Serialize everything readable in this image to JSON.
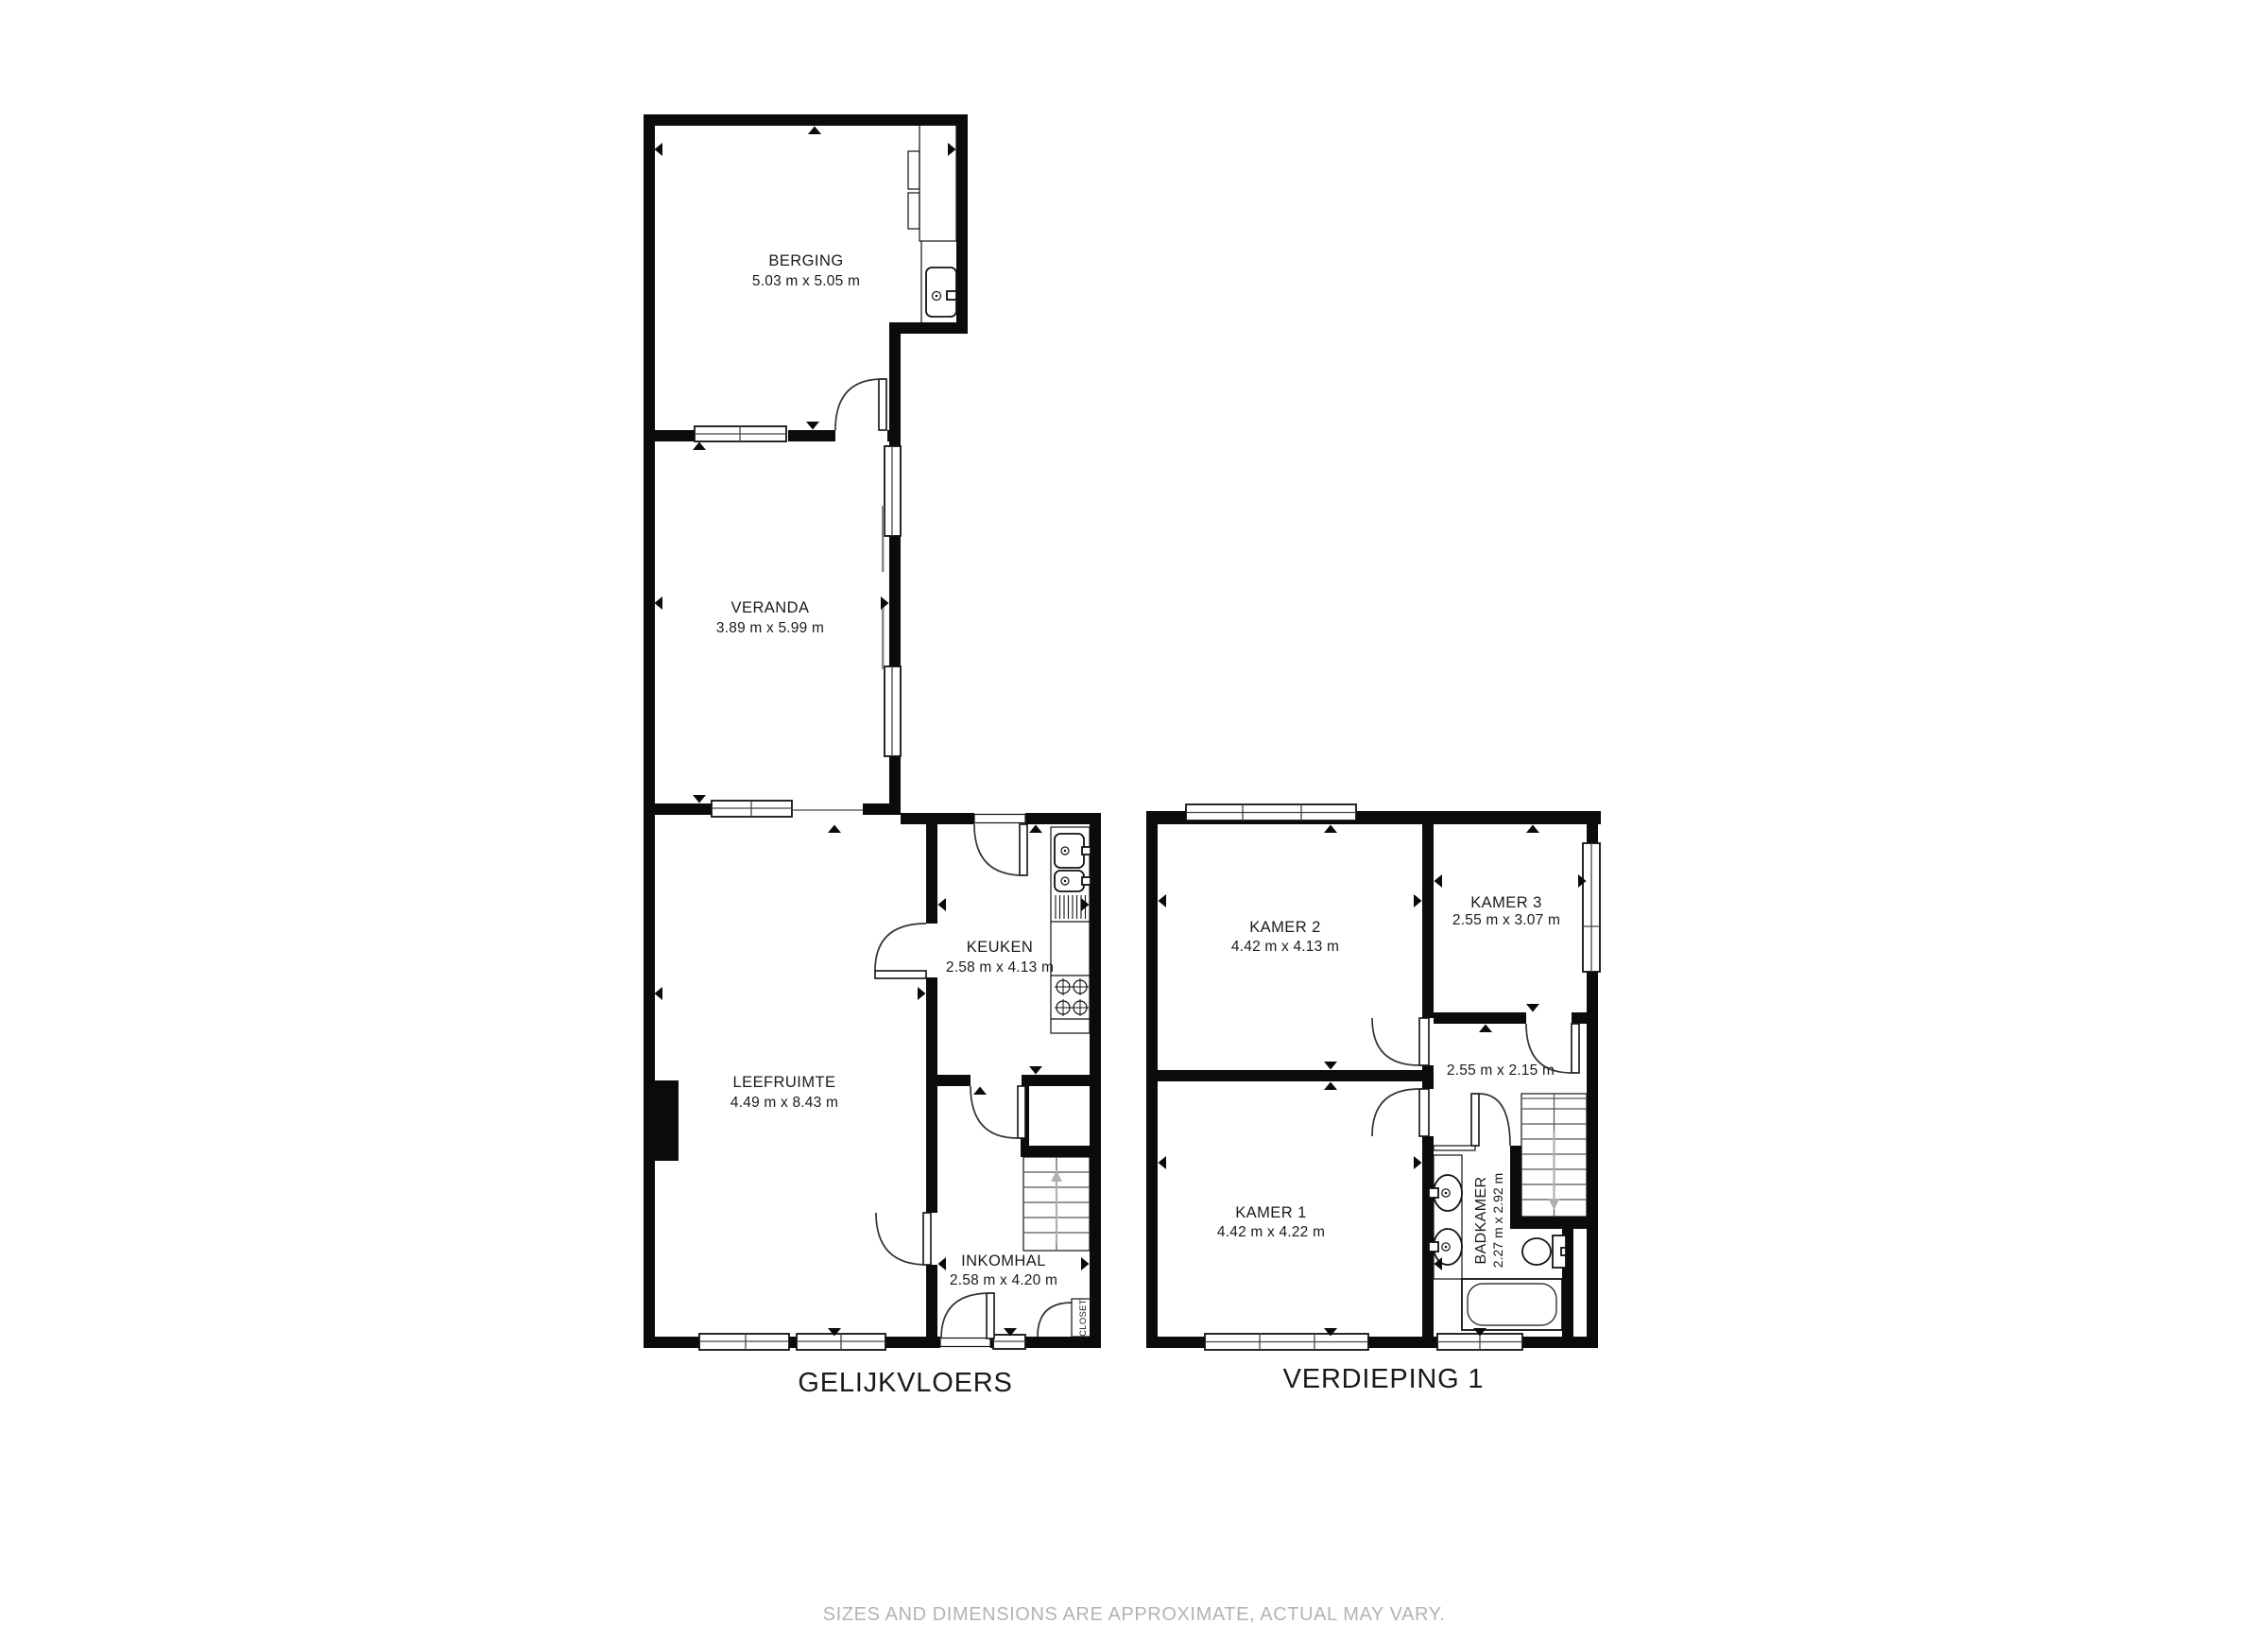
{
  "page": {
    "background": "#ffffff",
    "accent_color": "#0b0b0b",
    "footer_text": "SIZES AND DIMENSIONS ARE APPROXIMATE, ACTUAL MAY VARY.",
    "footer_color": "#b3b3b3"
  },
  "floors": [
    {
      "title": "GELIJKVLOERS",
      "rooms": [
        {
          "name": "BERGING",
          "dims": "5.03 m x 5.05 m"
        },
        {
          "name": "VERANDA",
          "dims": "3.89 m x 5.99 m"
        },
        {
          "name": "KEUKEN",
          "dims": "2.58 m x 4.13 m"
        },
        {
          "name": "LEEFRUIMTE",
          "dims": "4.49 m x 8.43 m"
        },
        {
          "name": "INKOMHAL",
          "dims": "2.58 m x 4.20 m"
        }
      ],
      "closet_label": "CLOSET"
    },
    {
      "title": "VERDIEPING 1",
      "rooms": [
        {
          "name": "KAMER 2",
          "dims": "4.42 m x 4.13 m"
        },
        {
          "name": "KAMER 3",
          "dims": "2.55 m x 3.07 m"
        },
        {
          "name": "",
          "dims": "2.55 m x 2.15 m"
        },
        {
          "name": "KAMER 1",
          "dims": "4.42 m x 4.22 m"
        },
        {
          "name": "BADKAMER",
          "dims": "2.27 m x 2.92 m"
        }
      ]
    }
  ]
}
